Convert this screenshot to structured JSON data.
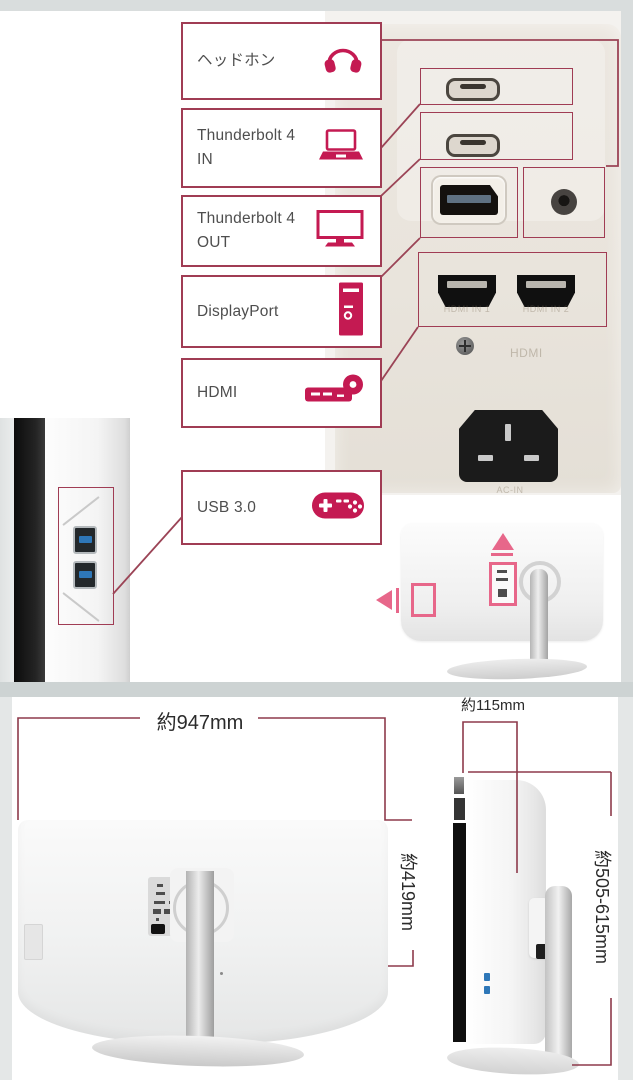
{
  "colors": {
    "accent_crimson": "#c41a52",
    "callout_line": "#9b4456",
    "callout_box_border": "#a03c54",
    "diagram_pink": "#e7678a",
    "dimension_line": "#8d3a4b",
    "usb_blue": "#2e77b8"
  },
  "callouts": [
    {
      "label": "ヘッドホン",
      "icon": "headphones-icon"
    },
    {
      "line1": "Thunderbolt 4",
      "line2": "IN",
      "icon": "laptop-icon"
    },
    {
      "line1": "Thunderbolt 4",
      "line2": "OUT",
      "icon": "monitor-icon"
    },
    {
      "label": "DisplayPort",
      "icon": "desktop-tower-icon"
    },
    {
      "label": "HDMI",
      "icon": "media-player-icon"
    },
    {
      "label": "USB 3.0",
      "icon": "gamepad-icon"
    }
  ],
  "rear_panel": {
    "embossed_labels": {
      "hdmi_in_1": "HDMI IN 1",
      "hdmi_in_2": "HDMI IN 2",
      "hdmi": "HDMI",
      "ac_in": "AC-IN"
    }
  },
  "dimensions": {
    "width": "約947mm",
    "height": "約419mm",
    "depth": "約115mm",
    "height_with_stand": "約505-615mm"
  }
}
